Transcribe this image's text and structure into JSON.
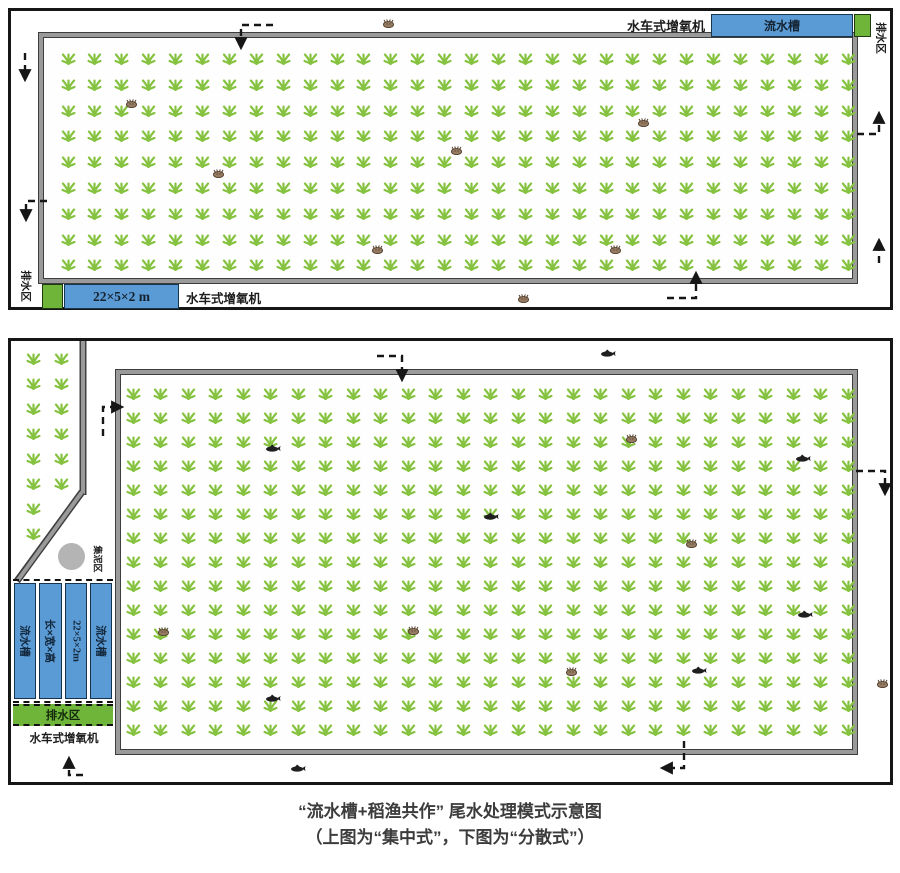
{
  "colors": {
    "blue": "#5b9bd5",
    "green": "#6fb53a",
    "rice": "#85c240",
    "crab": "#967b63",
    "ink": "#1f1f1f",
    "circle": "#b4b4b4"
  },
  "top": {
    "aerator_top": "水车式增氧机",
    "trough": "流水槽",
    "drain_right": "排水区",
    "drain_left": "排水区",
    "dims": "22×5×2 m",
    "aerator_bottom": "水车式增氧机"
  },
  "bottom": {
    "sump": "集泥区",
    "troughs": [
      "流水槽",
      "长×宽×高",
      "22×5×2m",
      "流水槽"
    ],
    "drain": "排水区",
    "aerator": "水车式增氧机"
  },
  "caption": {
    "line1": "“流水槽+稻渔共作” 尾水处理模式示意图",
    "line2": "（上图为“集中式”，下图为“分散式”）"
  },
  "rice_grids": {
    "top_field": [
      {
        "x0": 57,
        "y0": 47,
        "dx": 26.9,
        "dy": 25.8,
        "cols": 30,
        "rows": 9
      }
    ],
    "bottom_field": [
      {
        "x0": 122,
        "y0": 52,
        "dx": 27.5,
        "dy": 24,
        "cols": 27,
        "rows": 15
      },
      {
        "x0": 22,
        "y0": 17,
        "dx": 0,
        "dy": 25,
        "cols": 1,
        "rows": 8
      },
      {
        "x0": 50,
        "y0": 17,
        "dx": 0,
        "dy": 25,
        "cols": 1,
        "rows": 6
      }
    ]
  },
  "animals": {
    "top": [
      {
        "t": "crab",
        "x": 377,
        "y": 12
      },
      {
        "t": "crab",
        "x": 120,
        "y": 92
      },
      {
        "t": "crab",
        "x": 207,
        "y": 162
      },
      {
        "t": "crab",
        "x": 445,
        "y": 139
      },
      {
        "t": "crab",
        "x": 632,
        "y": 111
      },
      {
        "t": "crab",
        "x": 366,
        "y": 238
      },
      {
        "t": "crab",
        "x": 604,
        "y": 238
      },
      {
        "t": "crab",
        "x": 512,
        "y": 287
      }
    ],
    "bottom": [
      {
        "t": "fish",
        "x": 597,
        "y": 12
      },
      {
        "t": "fish",
        "x": 262,
        "y": 107
      },
      {
        "t": "fish",
        "x": 792,
        "y": 117
      },
      {
        "t": "crab",
        "x": 620,
        "y": 97
      },
      {
        "t": "fish",
        "x": 480,
        "y": 175
      },
      {
        "t": "crab",
        "x": 680,
        "y": 202
      },
      {
        "t": "crab",
        "x": 152,
        "y": 290
      },
      {
        "t": "crab",
        "x": 402,
        "y": 289
      },
      {
        "t": "fish",
        "x": 794,
        "y": 273
      },
      {
        "t": "crab",
        "x": 560,
        "y": 330
      },
      {
        "t": "fish",
        "x": 688,
        "y": 329
      },
      {
        "t": "fish",
        "x": 262,
        "y": 357
      },
      {
        "t": "fish",
        "x": 287,
        "y": 427
      },
      {
        "t": "crab",
        "x": 871,
        "y": 342
      }
    ]
  }
}
